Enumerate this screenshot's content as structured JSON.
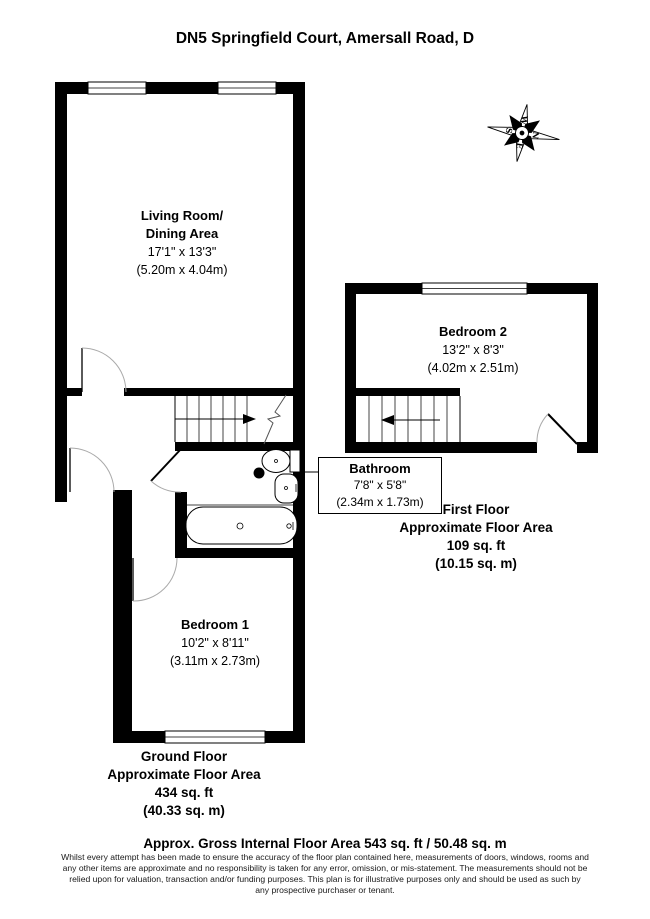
{
  "title": "DN5 Springfield Court, Amersall Road, D",
  "compass": {
    "n": "N",
    "e": "E",
    "s": "S",
    "w": "W"
  },
  "rooms": {
    "living": {
      "name_line1": "Living Room/",
      "name_line2": "Dining Area",
      "dims_imperial": "17'1\" x 13'3\"",
      "dims_metric": "(5.20m x 4.04m)"
    },
    "bedroom2": {
      "name": "Bedroom 2",
      "dims_imperial": "13'2\" x 8'3\"",
      "dims_metric": "(4.02m x 2.51m)"
    },
    "bathroom": {
      "name": "Bathroom",
      "dims_imperial": "7'8\" x 5'8\"",
      "dims_metric": "(2.34m x 1.73m)"
    },
    "bedroom1": {
      "name": "Bedroom 1",
      "dims_imperial": "10'2\" x 8'11\"",
      "dims_metric": "(3.11m x 2.73m)"
    }
  },
  "floors": {
    "first": {
      "line1": "First Floor",
      "line2": "Approximate Floor Area",
      "line3": "109 sq. ft",
      "line4": "(10.15 sq. m)"
    },
    "ground": {
      "line1": "Ground Floor",
      "line2": "Approximate Floor Area",
      "line3": "434 sq. ft",
      "line4": "(40.33 sq. m)"
    }
  },
  "footer": {
    "summary": "Approx. Gross Internal Floor Area 543 sq. ft / 50.48 sq. m",
    "disclaimer": [
      "Whilst every attempt has been made to ensure the accuracy of the floor plan contained here, measurements of doors, windows, rooms and",
      "any other items are approximate and no responsibility is taken for any error, omission, or mis-statement. The measurements should not be",
      "relied upon for valuation, transaction and/or funding purposes. This plan is for illustrative purposes only and should be used as such by",
      "any prospective purchaser or tenant."
    ]
  }
}
